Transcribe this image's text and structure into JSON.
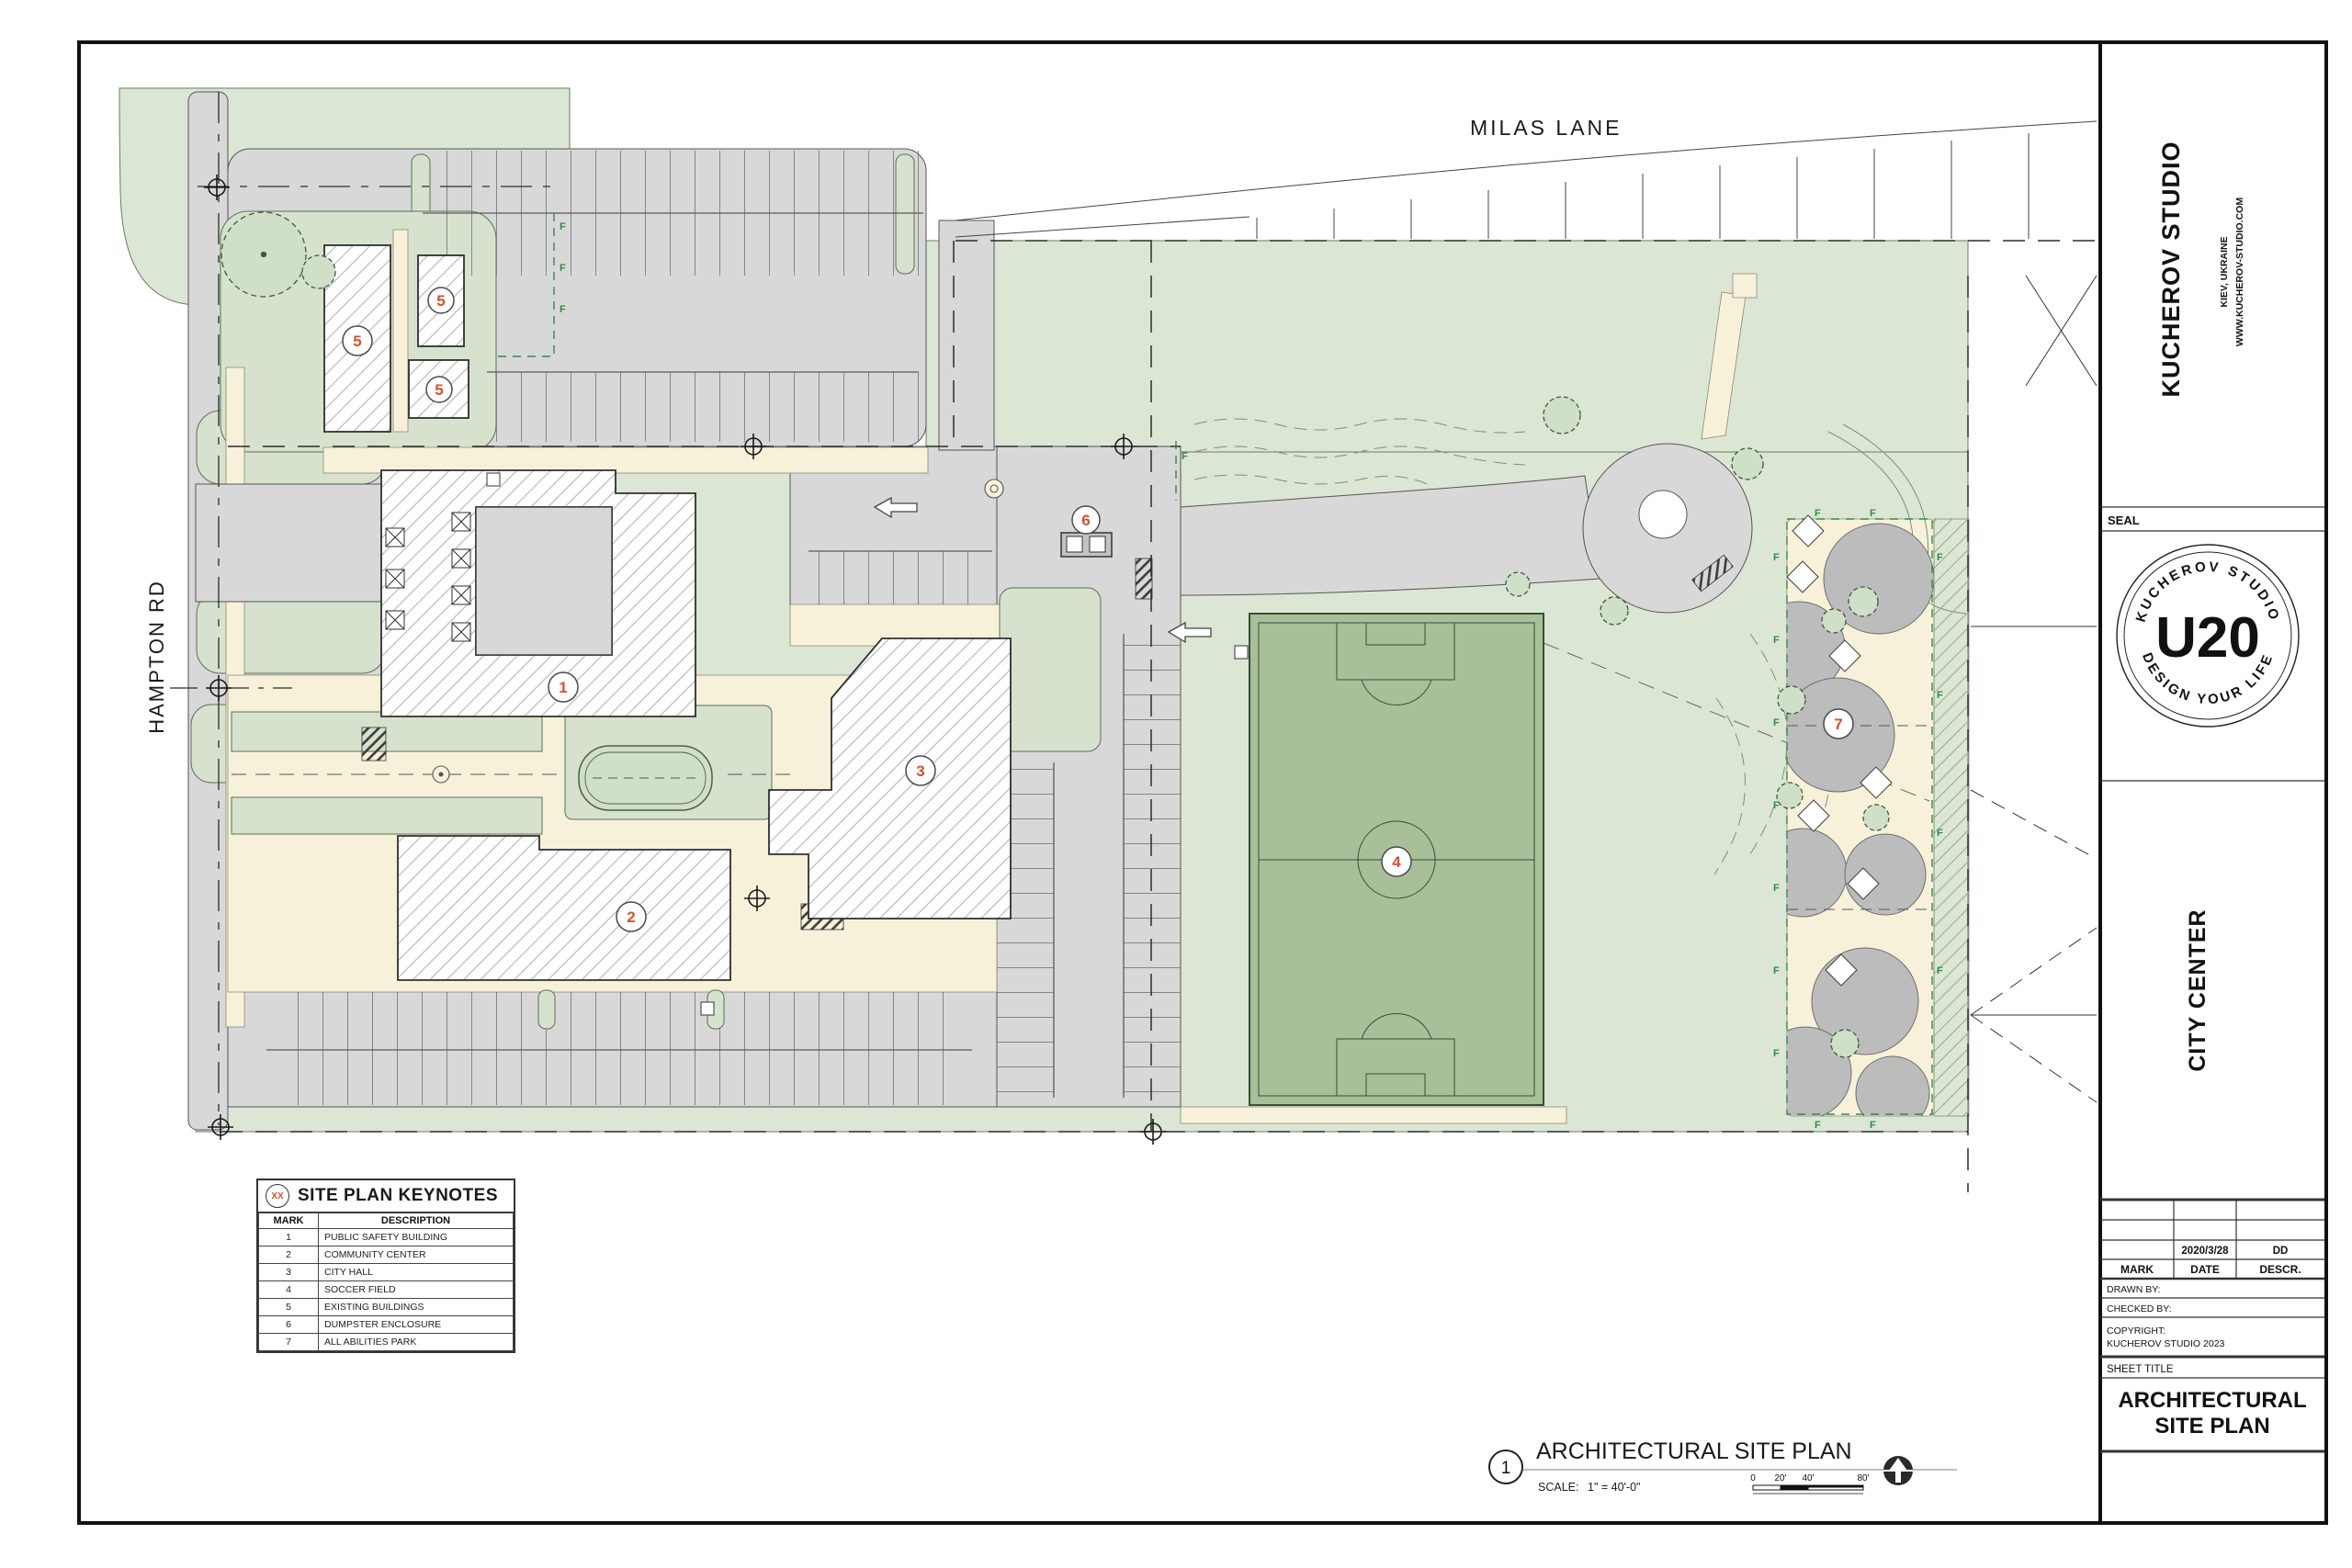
{
  "title_block": {
    "studio": "KUCHEROV STUDIO",
    "location": "KIEV, UKRAINE",
    "website": "WWW.KUCHEROV-STUDIO.COM",
    "seal_label": "SEAL",
    "seal": {
      "top": "KUCHEROV STUDIO",
      "center": "U20",
      "bottom": "DESIGN YOUR LIFE"
    },
    "project": "CITY CENTER",
    "revision": {
      "date": "2020/3/28",
      "descr": "DD",
      "headers": {
        "mark": "MARK",
        "date": "DATE",
        "descr": "DESCR."
      }
    },
    "drawn_by": "DRAWN BY:",
    "checked_by": "CHECKED BY:",
    "copyright_label": "COPYRIGHT:",
    "copyright": "KUCHEROV STUDIO 2023",
    "sheet_title_label": "SHEET TITLE",
    "sheet_title_line1": "ARCHITECTURAL",
    "sheet_title_line2": "SITE PLAN"
  },
  "plan": {
    "road_top": "MILAS LANE",
    "road_left": "HAMPTON RD",
    "fence_marker": "F",
    "badges": [
      "1",
      "2",
      "3",
      "4",
      "5",
      "5",
      "5",
      "6",
      "7"
    ]
  },
  "keynotes": {
    "symbol": "XX",
    "title": "SITE PLAN KEYNOTES",
    "headers": {
      "mark": "MARK",
      "desc": "DESCRIPTION"
    },
    "rows": [
      {
        "mark": "1",
        "desc": "PUBLIC SAFETY BUILDING"
      },
      {
        "mark": "2",
        "desc": "COMMUNITY CENTER"
      },
      {
        "mark": "3",
        "desc": "CITY HALL"
      },
      {
        "mark": "4",
        "desc": "SOCCER FIELD"
      },
      {
        "mark": "5",
        "desc": "EXISTING BUILDINGS"
      },
      {
        "mark": "6",
        "desc": "DUMPSTER ENCLOSURE"
      },
      {
        "mark": "7",
        "desc": "ALL ABILITIES PARK"
      }
    ]
  },
  "drawing_title": {
    "number": "1",
    "title": "ARCHITECTURAL SITE PLAN",
    "scale_label": "SCALE:",
    "scale_value": "1\" = 40'-0\"",
    "scalebar": {
      "t0": "0",
      "t1": "20'",
      "t2": "40'",
      "t3": "80'"
    }
  },
  "colors": {
    "accent_red": "#d4502e",
    "landscape_green": "#dbe6d4",
    "field_green": "#a9bf99",
    "pavement_gray": "#d8d8d8",
    "walk_cream": "#f8f1da",
    "fence_green": "#2f8c46"
  }
}
